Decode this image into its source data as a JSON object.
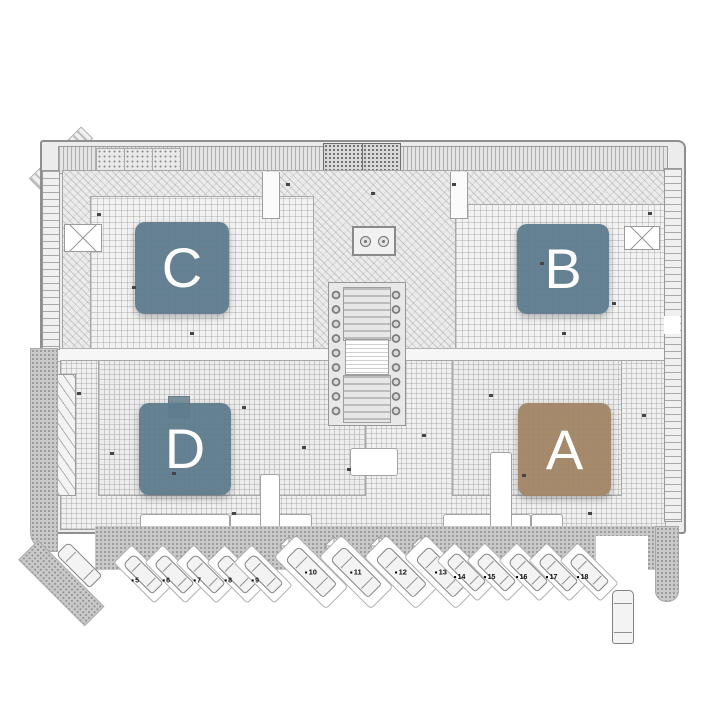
{
  "blocks": {
    "a": {
      "label": "A",
      "color": "#a28566"
    },
    "b": {
      "label": "B",
      "color": "#5e7c8e"
    },
    "c": {
      "label": "C",
      "color": "#5e7c8e"
    },
    "d": {
      "label": "D",
      "color": "#5e7c8e"
    }
  },
  "parking": {
    "stalls": [
      {
        "number": "5"
      },
      {
        "number": "6"
      },
      {
        "number": "7"
      },
      {
        "number": "8"
      },
      {
        "number": "9"
      },
      {
        "number": "10"
      },
      {
        "number": "11"
      },
      {
        "number": "12"
      },
      {
        "number": "13"
      },
      {
        "number": "14"
      },
      {
        "number": "15"
      },
      {
        "number": "16"
      },
      {
        "number": "17"
      },
      {
        "number": "18"
      }
    ]
  },
  "icons": {
    "car": "top-view-car (css shape)",
    "column": "circle",
    "planter": "stipple square",
    "cross_panel": "x-hatch square"
  },
  "colors": {
    "block_blue": "#5e7c8e",
    "block_brown": "#a28566",
    "road_gray": "#c9c9c9",
    "line_gray": "#8f8f8f"
  }
}
